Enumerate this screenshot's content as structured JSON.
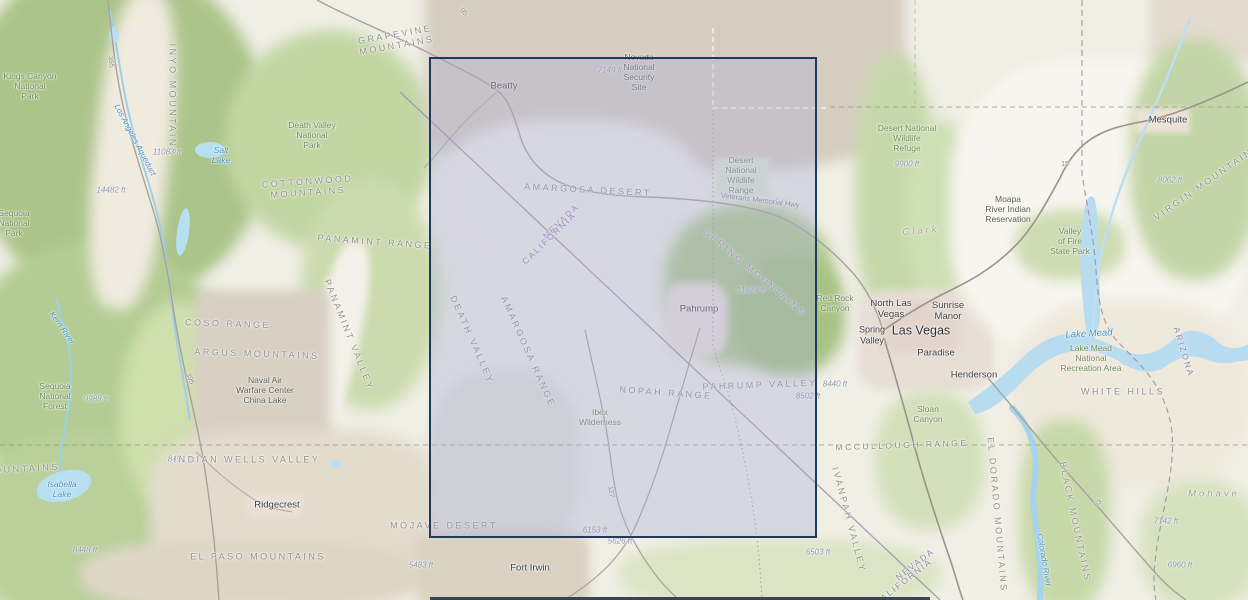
{
  "map": {
    "type": "topographic-basemap",
    "region": "Death Valley / Pahrump / Las Vegas area (California - Nevada - Arizona)",
    "colors": {
      "base_land": "#f0efe6",
      "vegetation": "#b9cf9a",
      "military_land": "#d5cec0",
      "urban": "#e7ded6",
      "water": "#b7dcf0",
      "selection_border": "#1f3a5c",
      "selection_fill": "rgba(170,172,215,0.35)",
      "bottom_bar": "#3a4350"
    },
    "selection": {
      "x": 429,
      "y": 57,
      "width": 388,
      "height": 481
    },
    "labels": [
      {
        "id": "kings-canyon-np",
        "kind": "park",
        "x": 30,
        "y": 86,
        "lines": [
          "Kings Canyon",
          "National",
          "Park"
        ]
      },
      {
        "id": "inyo-mountains",
        "kind": "terrain",
        "x": 172,
        "y": 100,
        "rot": 90,
        "text": "INYO MOUNTAINS"
      },
      {
        "id": "los-angeles-aqueduct",
        "kind": "water",
        "x": 135,
        "y": 140,
        "rot": 62,
        "text": "Los Angeles Aqueduct",
        "size": 8
      },
      {
        "id": "elev-11083",
        "kind": "elev",
        "x": 167,
        "y": 152,
        "text": "11083 ft"
      },
      {
        "id": "salt-lake",
        "kind": "water",
        "x": 221,
        "y": 155,
        "lines": [
          "Salt",
          "Lake"
        ]
      },
      {
        "id": "elev-14482",
        "kind": "elev",
        "x": 111,
        "y": 190,
        "text": "14482 ft"
      },
      {
        "id": "grapevine-mountains",
        "kind": "terrain",
        "x": 396,
        "y": 40,
        "rot": -10,
        "lines": [
          "GRAPEVINE",
          "MOUNTAINS"
        ]
      },
      {
        "id": "death-valley-np",
        "kind": "park",
        "x": 312,
        "y": 135,
        "lines": [
          "Death Valley",
          "National",
          "Park"
        ]
      },
      {
        "id": "cottonwood-mountains",
        "kind": "terrain",
        "x": 308,
        "y": 187,
        "rot": -4,
        "lines": [
          "COTTONWOOD",
          "MOUNTAINS"
        ]
      },
      {
        "id": "sequoia-np",
        "kind": "park",
        "x": 14,
        "y": 223,
        "lines": [
          "Sequoia",
          "National",
          "Park"
        ]
      },
      {
        "id": "kern-river",
        "kind": "water",
        "x": 62,
        "y": 328,
        "rot": 55,
        "text": "Kern River",
        "size": 8
      },
      {
        "id": "panamint-range",
        "kind": "terrain",
        "x": 375,
        "y": 242,
        "rot": 4,
        "text": "PANAMINT RANGE"
      },
      {
        "id": "panamint-valley",
        "kind": "terrain",
        "x": 349,
        "y": 335,
        "rot": 68,
        "text": "PANAMINT VALLEY"
      },
      {
        "id": "coso-range",
        "kind": "terrain",
        "x": 228,
        "y": 324,
        "rot": 2,
        "text": "COSO RANGE"
      },
      {
        "id": "argus-mountains",
        "kind": "terrain",
        "x": 257,
        "y": 354,
        "rot": 2,
        "text": "ARGUS MOUNTAINS"
      },
      {
        "id": "naval-air-warfare-center",
        "kind": "area",
        "x": 265,
        "y": 390,
        "lines": [
          "Naval Air",
          "Warfare Center",
          "China Lake"
        ]
      },
      {
        "id": "sequoia-nf",
        "kind": "park",
        "x": 55,
        "y": 396,
        "lines": [
          "Sequoia",
          "National",
          "Forest"
        ]
      },
      {
        "id": "elev-9988",
        "kind": "elev",
        "x": 96,
        "y": 399,
        "text": "9988 ft"
      },
      {
        "id": "route-395-north",
        "kind": "route",
        "x": 110,
        "y": 62,
        "rot": 84,
        "text": "395"
      },
      {
        "id": "route-395-south",
        "kind": "route",
        "x": 189,
        "y": 379,
        "rot": 68,
        "text": "395"
      },
      {
        "id": "mountains-cut",
        "kind": "terrain",
        "x": 22,
        "y": 469,
        "rot": -3,
        "text": "MOUNTAINS"
      },
      {
        "id": "isabella-lake",
        "kind": "water",
        "x": 62,
        "y": 489,
        "lines": [
          "Isabella",
          "Lake"
        ]
      },
      {
        "id": "elev-8451",
        "kind": "elev",
        "x": 180,
        "y": 459,
        "text": "8451 ft"
      },
      {
        "id": "indian-wells-valley",
        "kind": "terrain",
        "x": 247,
        "y": 460,
        "text": "INDIAN WELLS VALLEY"
      },
      {
        "id": "ridgecrest",
        "kind": "city",
        "x": 277,
        "y": 505,
        "text": "Ridgecrest"
      },
      {
        "id": "elev-8448",
        "kind": "elev",
        "x": 85,
        "y": 550,
        "text": "8448 ft"
      },
      {
        "id": "el-paso-mountains",
        "kind": "terrain",
        "x": 258,
        "y": 557,
        "text": "EL PASO MOUNTAINS"
      },
      {
        "id": "elev-5483",
        "kind": "elev",
        "x": 421,
        "y": 565,
        "text": "5483 ft"
      },
      {
        "id": "mojave-desert",
        "kind": "terrain",
        "x": 444,
        "y": 526,
        "text": "MOJAVE DESERT"
      },
      {
        "id": "fort-irwin",
        "kind": "city",
        "x": 530,
        "y": 568,
        "text": "Fort Irwin"
      },
      {
        "id": "beatty",
        "kind": "city",
        "x": 504,
        "y": 86,
        "text": "Beatty"
      },
      {
        "id": "elev-7149",
        "kind": "elev",
        "x": 610,
        "y": 70,
        "text": "7149 ft"
      },
      {
        "id": "nevada-national-security-site",
        "kind": "area",
        "x": 639,
        "y": 72,
        "lines": [
          "Nevada",
          "National",
          "Security",
          "Site"
        ]
      },
      {
        "id": "route-95",
        "kind": "route",
        "x": 463,
        "y": 13,
        "rot": 40,
        "text": "95"
      },
      {
        "id": "amargosa-desert",
        "kind": "terrain",
        "x": 588,
        "y": 190,
        "rot": 3,
        "text": "AMARGOSA DESERT"
      },
      {
        "id": "desert-nwr-range",
        "kind": "park",
        "x": 741,
        "y": 175,
        "lines": [
          "Desert",
          "National",
          "Wildlife",
          "Range"
        ]
      },
      {
        "id": "veterans-memorial-hwy",
        "kind": "route",
        "x": 760,
        "y": 201,
        "rot": 7,
        "text": "Veterans Memorial Hwy",
        "size": 7.5
      },
      {
        "id": "nevada-label-1",
        "kind": "state",
        "x": 561,
        "y": 221,
        "rot": -44,
        "text": "NEVADA"
      },
      {
        "id": "california-label-1",
        "kind": "state",
        "x": 549,
        "y": 238,
        "rot": -44,
        "text": "CALIFORNIA"
      },
      {
        "id": "death-valley",
        "kind": "terrain",
        "x": 472,
        "y": 340,
        "rot": 66,
        "text": "DEATH VALLEY"
      },
      {
        "id": "amargosa-range",
        "kind": "terrain",
        "x": 528,
        "y": 352,
        "rot": 66,
        "text": "AMARGOSA RANGE"
      },
      {
        "id": "pahrump",
        "kind": "city",
        "x": 699,
        "y": 309,
        "text": "Pahrump"
      },
      {
        "id": "elev-11919",
        "kind": "elev",
        "x": 751,
        "y": 290,
        "text": "11919 ft"
      },
      {
        "id": "spring-mountains",
        "kind": "terrain",
        "x": 755,
        "y": 273,
        "rot": 40,
        "text": "SPRING MOUNTAINS"
      },
      {
        "id": "nopah-range",
        "kind": "terrain",
        "x": 666,
        "y": 393,
        "rot": 4,
        "text": "NOPAH RANGE"
      },
      {
        "id": "pahrump-valley",
        "kind": "terrain",
        "x": 760,
        "y": 385,
        "rot": -2,
        "text": "PAHRUMP VALLEY"
      },
      {
        "id": "elev-8502",
        "kind": "elev",
        "x": 808,
        "y": 396,
        "text": "8502 ft"
      },
      {
        "id": "ibex-wilderness",
        "kind": "park",
        "x": 600,
        "y": 417,
        "lines": [
          "Ibex",
          "Wilderness"
        ]
      },
      {
        "id": "route-127",
        "kind": "route",
        "x": 610,
        "y": 492,
        "rot": 82,
        "text": "127"
      },
      {
        "id": "elev-6153",
        "kind": "elev",
        "x": 595,
        "y": 530,
        "text": "6153 ft"
      },
      {
        "id": "elev-5626",
        "kind": "elev",
        "x": 620,
        "y": 541,
        "text": "5626 ft"
      },
      {
        "id": "elev-6503",
        "kind": "elev",
        "x": 818,
        "y": 552,
        "text": "6503 ft"
      },
      {
        "id": "red-rock-canyon",
        "kind": "park",
        "x": 835,
        "y": 303,
        "lines": [
          "Red Rock",
          "Canyon"
        ]
      },
      {
        "id": "elev-8440",
        "kind": "elev",
        "x": 835,
        "y": 384,
        "text": "8440 ft"
      },
      {
        "id": "clark-county",
        "kind": "county",
        "x": 921,
        "y": 231,
        "rot": -5,
        "text": "Clark"
      },
      {
        "id": "north-las-vegas",
        "kind": "city",
        "x": 891,
        "y": 309,
        "lines": [
          "North Las",
          "Vegas"
        ]
      },
      {
        "id": "sunrise-manor",
        "kind": "city",
        "x": 948,
        "y": 311,
        "lines": [
          "Sunrise",
          "Manor"
        ]
      },
      {
        "id": "las-vegas",
        "kind": "city-lg",
        "x": 921,
        "y": 331,
        "text": "Las Vegas"
      },
      {
        "id": "spring-valley-city",
        "kind": "city",
        "x": 872,
        "y": 335,
        "size": 9,
        "lines": [
          "Spring",
          "Valley"
        ]
      },
      {
        "id": "paradise",
        "kind": "city",
        "x": 936,
        "y": 353,
        "text": "Paradise"
      },
      {
        "id": "henderson",
        "kind": "city",
        "x": 974,
        "y": 375,
        "text": "Henderson"
      },
      {
        "id": "moapa-reservation",
        "kind": "area",
        "x": 1008,
        "y": 209,
        "lines": [
          "Moapa",
          "River Indian",
          "Reservation"
        ]
      },
      {
        "id": "valley-of-fire",
        "kind": "park",
        "x": 1070,
        "y": 241,
        "lines": [
          "Valley",
          "of Fire",
          "State Park"
        ]
      },
      {
        "id": "lake-mead",
        "kind": "water",
        "x": 1089,
        "y": 334,
        "rot": -3,
        "text": "Lake Mead",
        "size": 9.5
      },
      {
        "id": "lake-mead-nra",
        "kind": "park",
        "x": 1091,
        "y": 358,
        "lines": [
          "Lake Mead",
          "National",
          "Recreation Area"
        ]
      },
      {
        "id": "arizona-label",
        "kind": "state",
        "x": 1184,
        "y": 352,
        "rot": 73,
        "text": "ARIZONA"
      },
      {
        "id": "desert-nwr-refuge",
        "kind": "park",
        "x": 907,
        "y": 138,
        "lines": [
          "Desert National",
          "Wildlife",
          "Refuge"
        ]
      },
      {
        "id": "elev-9900",
        "kind": "elev",
        "x": 907,
        "y": 164,
        "text": "9900 ft"
      },
      {
        "id": "mesquite",
        "kind": "city",
        "x": 1168,
        "y": 120,
        "text": "Mesquite"
      },
      {
        "id": "elev-8062",
        "kind": "elev",
        "x": 1170,
        "y": 180,
        "text": "8062 ft"
      },
      {
        "id": "virgin-mountains",
        "kind": "terrain",
        "x": 1207,
        "y": 182,
        "rot": -35,
        "text": "VIRGIN MOUNTAINS"
      },
      {
        "id": "route-15",
        "kind": "route",
        "x": 1065,
        "y": 165,
        "text": "15"
      },
      {
        "id": "white-hills",
        "kind": "terrain",
        "x": 1123,
        "y": 392,
        "text": "WHITE HILLS"
      },
      {
        "id": "sloan-canyon",
        "kind": "park",
        "x": 928,
        "y": 414,
        "lines": [
          "Sloan",
          "Canyon"
        ]
      },
      {
        "id": "mccullough-range",
        "kind": "terrain",
        "x": 902,
        "y": 445,
        "rot": -2,
        "size": 8.5,
        "text": "MCCULLOUGH RANGE"
      },
      {
        "id": "ivanpah-valley",
        "kind": "terrain",
        "x": 849,
        "y": 520,
        "rot": 75,
        "text": "IVANPAH VALLEY"
      },
      {
        "id": "nevada-label-2",
        "kind": "state",
        "x": 915,
        "y": 564,
        "rot": -38,
        "text": "NEVADA"
      },
      {
        "id": "california-label-2",
        "kind": "state",
        "x": 903,
        "y": 582,
        "rot": -38,
        "text": "CALIFORNIA"
      },
      {
        "id": "el-dorado-mountains",
        "kind": "terrain",
        "x": 997,
        "y": 515,
        "rot": 85,
        "text": "EL DORADO MOUNTAINS"
      },
      {
        "id": "colorado-river",
        "kind": "water",
        "x": 1044,
        "y": 560,
        "rot": 80,
        "text": "Colorado River",
        "size": 8
      },
      {
        "id": "black-mountains",
        "kind": "terrain",
        "x": 1075,
        "y": 522,
        "rot": 78,
        "text": "BLACK MOUNTAINS"
      },
      {
        "id": "route-93",
        "kind": "route",
        "x": 1099,
        "y": 504,
        "rot": -50,
        "text": "93"
      },
      {
        "id": "mohave-county",
        "kind": "county",
        "x": 1214,
        "y": 494,
        "text": "Mohave"
      },
      {
        "id": "elev-7142",
        "kind": "elev",
        "x": 1166,
        "y": 521,
        "text": "7142 ft"
      },
      {
        "id": "elev-6960",
        "kind": "elev",
        "x": 1180,
        "y": 565,
        "text": "6960 ft"
      }
    ]
  }
}
